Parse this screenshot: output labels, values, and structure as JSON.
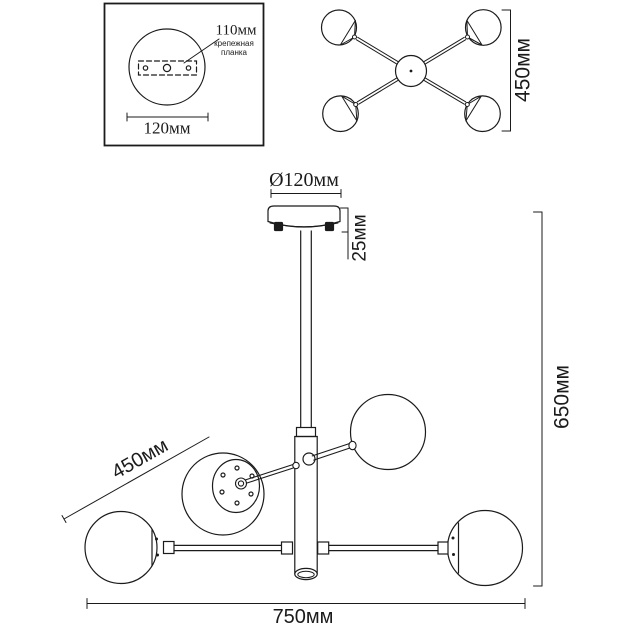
{
  "drawing": {
    "ink_color": "#1b1b1b",
    "background_color": "#ffffff",
    "mounting_plate_view": {
      "hole_spacing": "110мм",
      "bracket_name_line1": "крепежная",
      "bracket_name_line2": "планка",
      "plate_diameter": "120мм"
    },
    "top_view": {
      "arm_span": "450мм"
    },
    "front_view": {
      "canopy_diameter": "Ø120мм",
      "canopy_height": "25мм",
      "arm_length": "450мм",
      "total_height": "650мм",
      "total_width": "750мм"
    }
  }
}
